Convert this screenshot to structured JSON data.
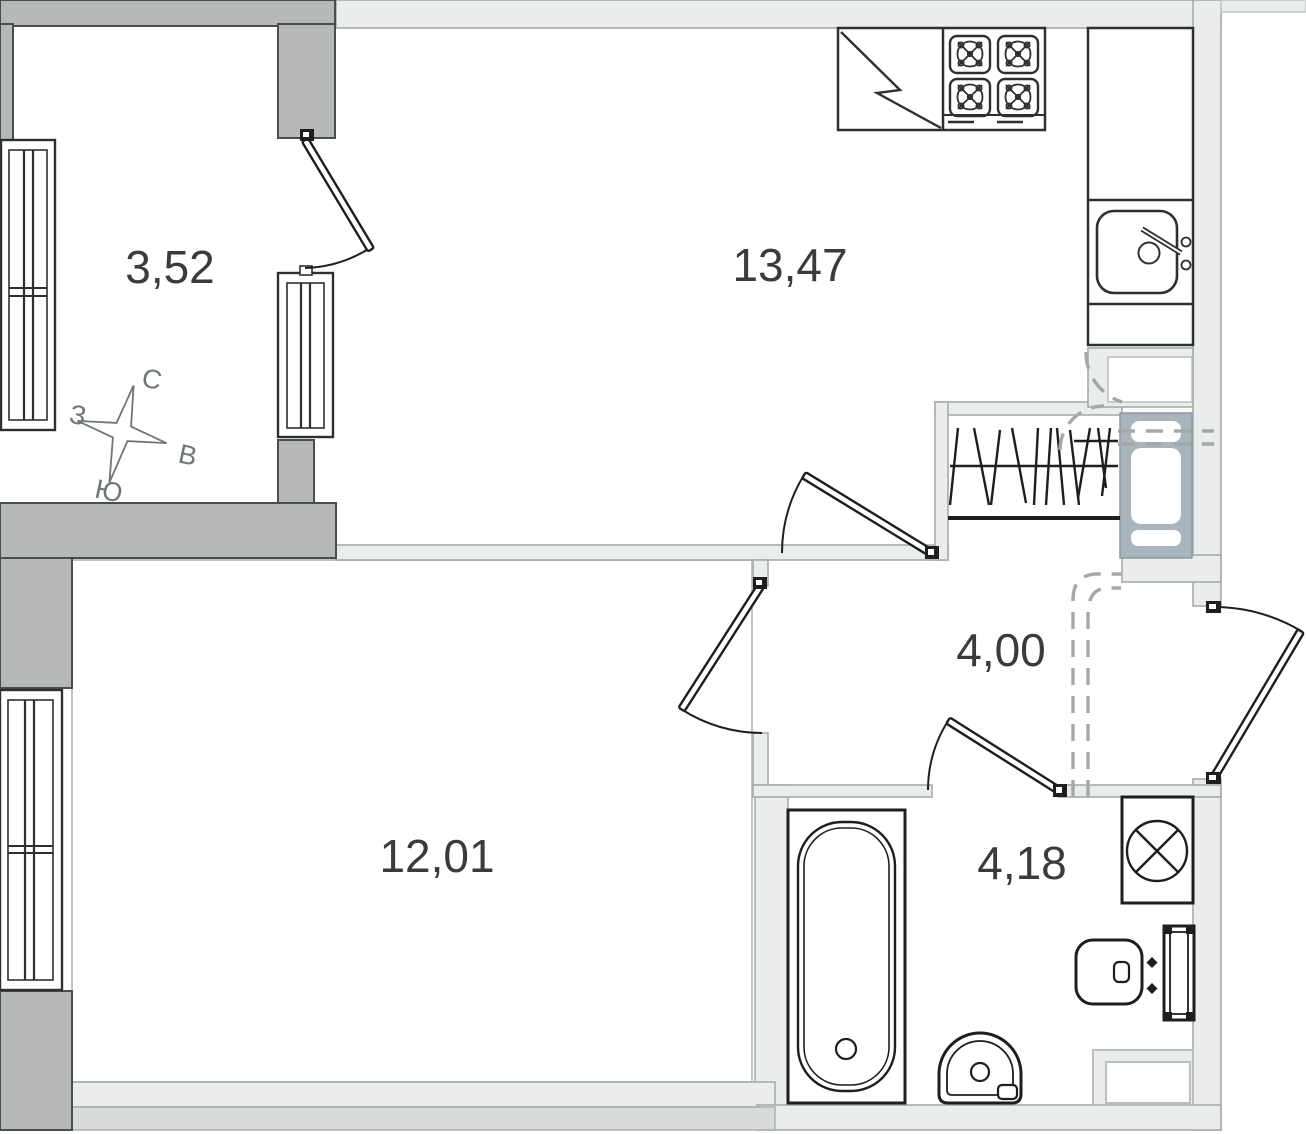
{
  "rooms": [
    {
      "id": "loggia",
      "area": "3,52"
    },
    {
      "id": "kitchen",
      "area": "13,47"
    },
    {
      "id": "hallway",
      "area": "4,00"
    },
    {
      "id": "living-room",
      "area": "12,01"
    },
    {
      "id": "bathroom",
      "area": "4,18"
    }
  ],
  "compass": {
    "north": "С",
    "west": "З",
    "east": "В",
    "south": "Ю"
  },
  "fixtures": [
    "gas-stove-icon",
    "countertop-break-icon",
    "kitchen-sink-icon",
    "wardrobe-hangers-icon",
    "ventilation-shaft-icon",
    "bathtub-icon",
    "washbasin-icon",
    "toilet-icon",
    "washing-machine-icon",
    "door-swing-icon",
    "window-icon",
    "compass-rose-icon"
  ],
  "colors": {
    "wall_structural": "#b7b9b9",
    "wall_partition": "#ebecec",
    "wall_outer_band": "#d9dbdb",
    "vent_shaft": "#a9b5bd",
    "line": "#2e3030",
    "dashed_duct": "#a3a9a9",
    "label_text": "#3a3c3c",
    "compass_text": "#6f7676"
  }
}
